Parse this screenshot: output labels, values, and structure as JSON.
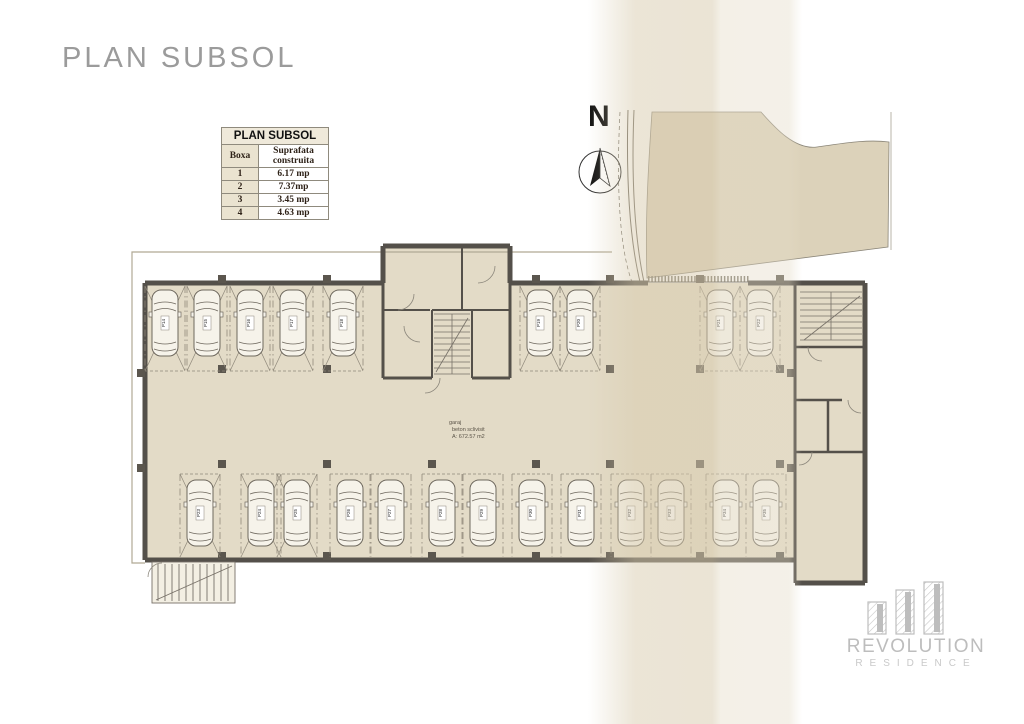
{
  "title": "PLAN SUBSOL",
  "legend_table": {
    "header": "PLAN SUBSOL",
    "columns": [
      "Boxa",
      "Suprafata construita"
    ],
    "rows": [
      [
        "1",
        "6.17 mp"
      ],
      [
        "2",
        "7.37mp"
      ],
      [
        "3",
        "3.45 mp"
      ],
      [
        "4",
        "4.63 mp"
      ]
    ]
  },
  "compass": {
    "label": "N"
  },
  "garage": {
    "name": "garaj",
    "finish": "beton  sclivisit",
    "area": "A: 672.57 m2"
  },
  "parking": {
    "groups": [
      {
        "name": "top-left",
        "orient": "down",
        "spots": [
          {
            "id": "P14",
            "x": 165,
            "cross": true
          },
          {
            "id": "P15",
            "x": 207,
            "cross": true
          },
          {
            "id": "P16",
            "x": 250,
            "cross": true
          },
          {
            "id": "P17",
            "x": 293,
            "cross": true
          },
          {
            "id": "P18",
            "x": 343,
            "cross": true
          }
        ]
      },
      {
        "name": "top-middle",
        "orient": "down",
        "spots": [
          {
            "id": "P19",
            "x": 540,
            "cross": true
          },
          {
            "id": "P20",
            "x": 580,
            "cross": true
          }
        ]
      },
      {
        "name": "top-right",
        "orient": "down",
        "spots": [
          {
            "id": "P21",
            "x": 720,
            "cross": true
          },
          {
            "id": "P22",
            "x": 760,
            "cross": true
          }
        ]
      },
      {
        "name": "bottom",
        "orient": "up",
        "spots": [
          {
            "id": "P23",
            "x": 200,
            "cross": true
          },
          {
            "id": "P24",
            "x": 261,
            "cross": true
          },
          {
            "id": "P25",
            "x": 297,
            "cross": true
          },
          {
            "id": "P26",
            "x": 350,
            "cross": false
          },
          {
            "id": "P27",
            "x": 391,
            "cross": false
          },
          {
            "id": "P28",
            "x": 442,
            "cross": false
          },
          {
            "id": "P29",
            "x": 483,
            "cross": false
          },
          {
            "id": "P30",
            "x": 532,
            "cross": false
          },
          {
            "id": "P31",
            "x": 581,
            "cross": false
          },
          {
            "id": "P32",
            "x": 631,
            "cross": false
          },
          {
            "id": "P33",
            "x": 671,
            "cross": false
          },
          {
            "id": "P34",
            "x": 726,
            "cross": false
          },
          {
            "id": "P35",
            "x": 766,
            "cross": false
          }
        ]
      }
    ]
  },
  "logo": {
    "brand": "REVOLUTION",
    "sub": "RESIDENCE"
  },
  "colors": {
    "floor": "#e3dbc7",
    "terrain": "#dcd2ba",
    "wall": "#54504a",
    "band": "#d8cbae",
    "title_text": "#9b9b9b",
    "logo_gray": "#bdbdbd"
  }
}
